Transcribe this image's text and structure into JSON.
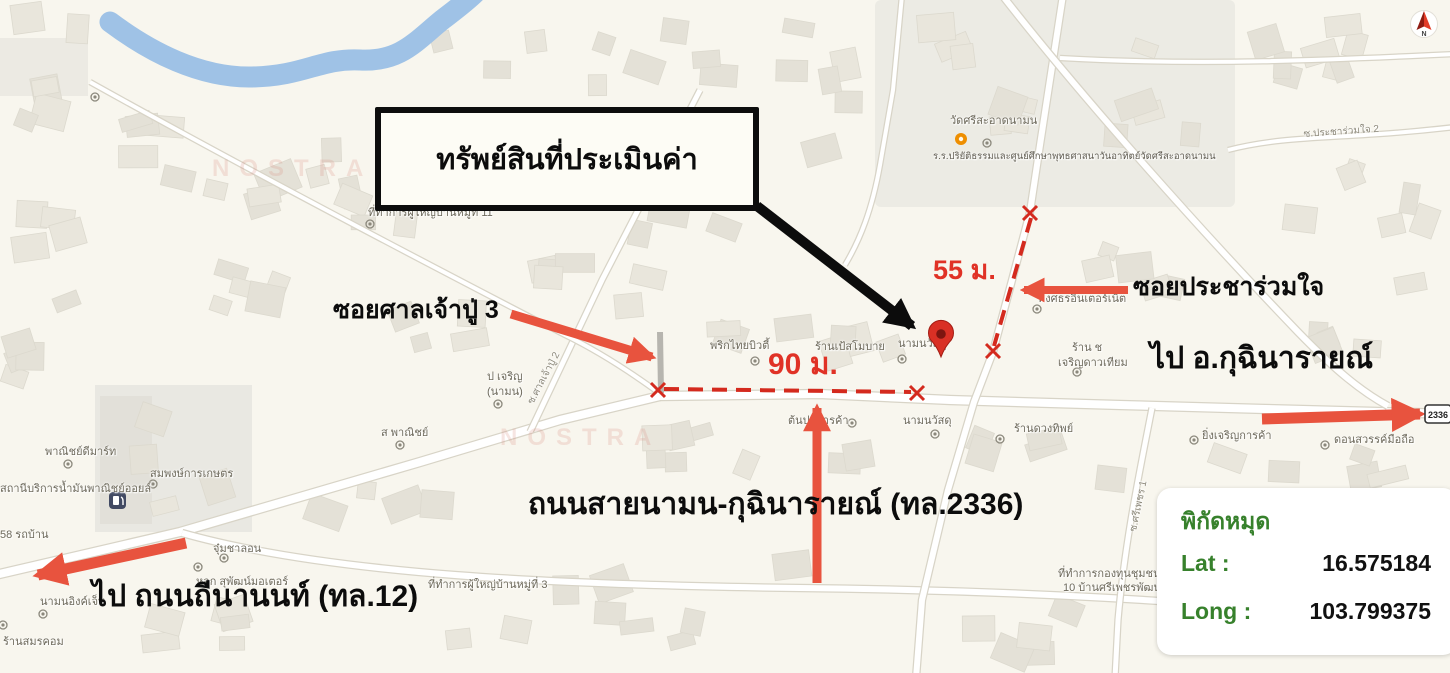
{
  "annotations": {
    "property_box": "ทรัพย์สินที่ประเมินค่า",
    "soi_san_chao_pu": "ซอยศาลเจ้าปู่ 3",
    "soi_pracha_ruam_jai": "ซอยประชาร่วมใจ",
    "to_kuchinarai": "ไป อ.กุฉินารายณ์",
    "road_namon_kuchinarai": "ถนนสายนามน-กุฉินารายณ์ (ทล.2336)",
    "to_thinanon": "ไป ถนนถีนานนท์ (ทล.12)",
    "dist_55": "55 ม.",
    "dist_90": "90 ม."
  },
  "coordinate_panel": {
    "title": "พิกัดหมุด",
    "lat_label": "Lat :",
    "lat_value": "16.575184",
    "long_label": "Long :",
    "long_value": "103.799375"
  },
  "highway_shield": "2336",
  "compass_n": "N",
  "watermark": "NOSTRA",
  "map_labels": [
    "วัดศรีสะอาดนามน",
    "ร.ร.ปริยัติธรรมและศูนย์ศึกษาพุทธศาสนาวันอาทิตย์วัดศรีสะอาดนามน",
    "ซ.ประชาร่วมใจ 2",
    "ที่ทำการผู้ใหญ่บ้านหมู่ที่ 11",
    "พงศธรอินเตอร์เน็ต",
    "ร้าน ช",
    "เจริญดาวเทียม",
    "พริกไทยบิวตี้",
    "ร้านเป้สโมบาย",
    "นามนวัสดุ",
    "ป เจริญ",
    "(นามน)",
    "ซ.ศาลเจ้าปู่ 2",
    "ส พาณิชย์",
    "ต้นปอการค้า",
    "นามนวัสดุ",
    "ร้านดวงทิพย์",
    "ยิ่งเจริญการค้า",
    "ดอนสวรรค์มือถือ",
    "พาณิชย์ดีมาร์ท",
    "สมพงษ์การเกษตร",
    "สถานีบริการน้ำมันพาณิชย์ออยล์",
    "58 รถบ้าน",
    "จุ๋มชาลอน",
    "หจก สุพัฒน์มอเตอร์",
    "นามนอิงค์เจ็ท",
    "ร้านสมรคอม",
    "ที่ทำการผู้ใหญ่บ้านหมู่ที่ 3",
    "ที่ทำการกองทุนชุมชนหมู่",
    "10 บ้านศรีเพชรพัฒนา",
    "ซ.ศรีเพชร 1"
  ]
}
